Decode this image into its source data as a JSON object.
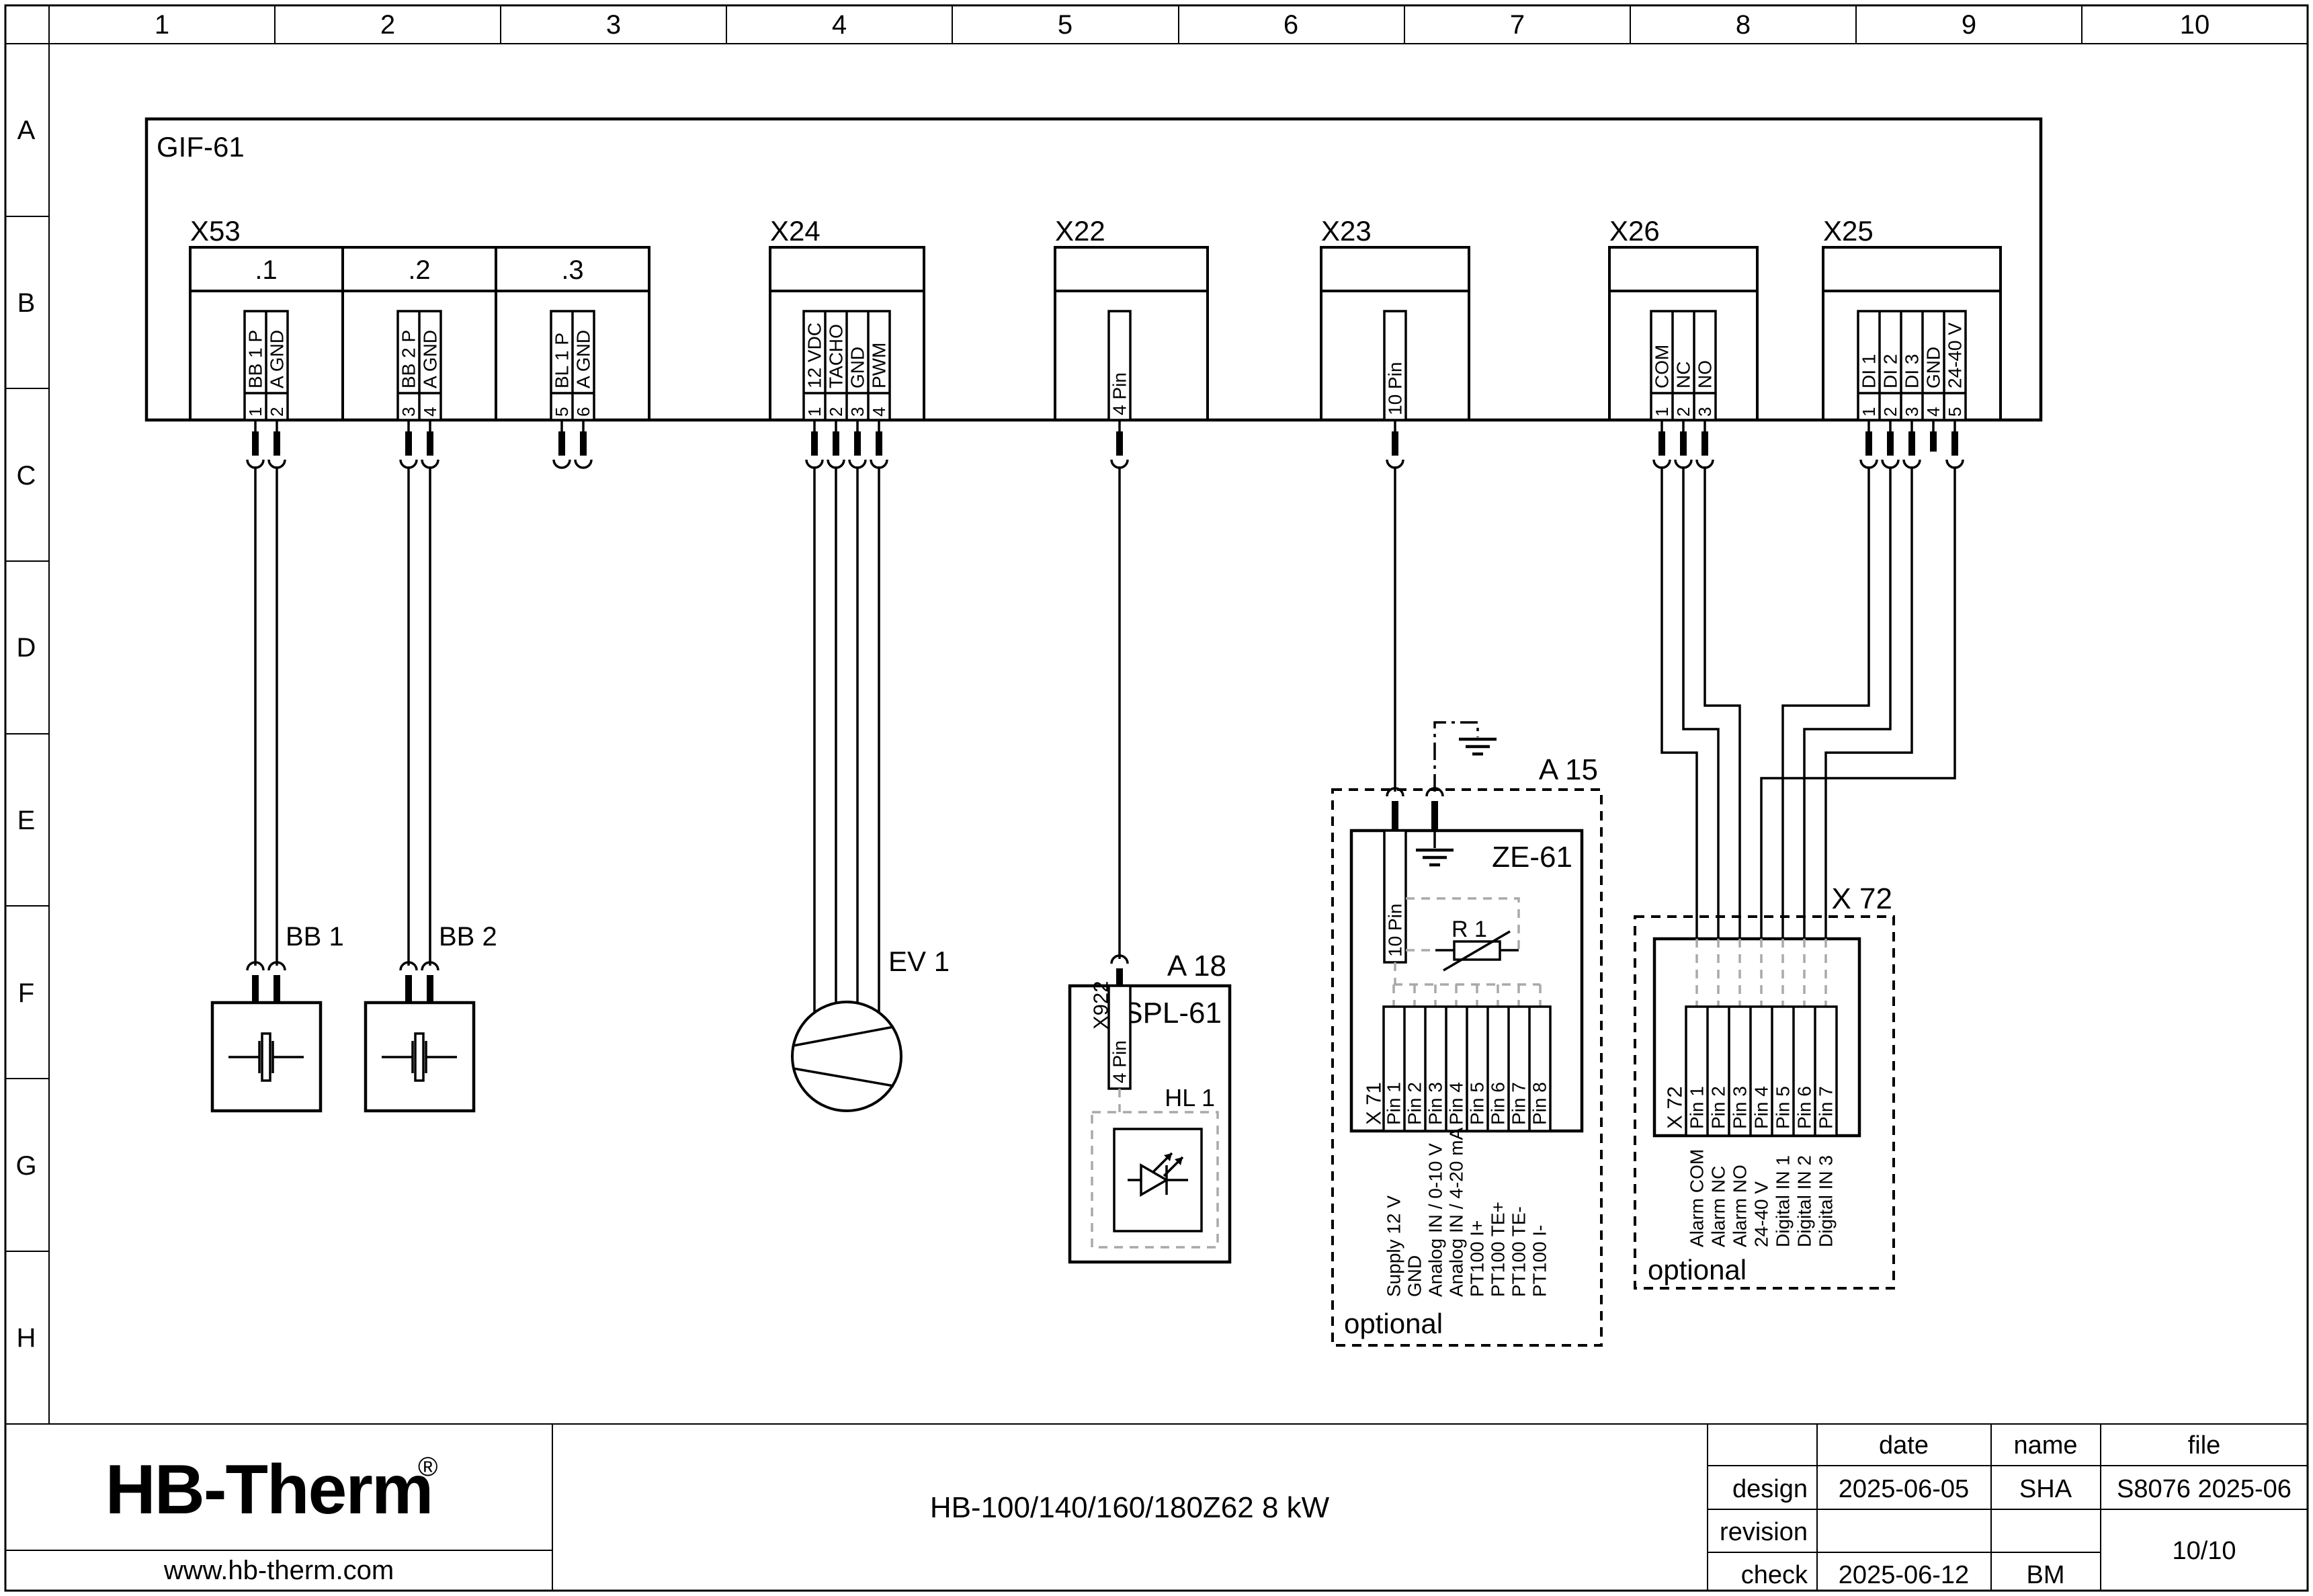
{
  "colors": {
    "line": "#000000",
    "gray_dash": "#a9a9a9",
    "logo_navy": "#1b2846"
  },
  "ruler": {
    "cols": [
      "1",
      "2",
      "3",
      "4",
      "5",
      "6",
      "7",
      "8",
      "9",
      "10"
    ],
    "rows": [
      "A",
      "B",
      "C",
      "D",
      "E",
      "F",
      "G",
      "H"
    ]
  },
  "unit": {
    "label": "GIF-61"
  },
  "x53": {
    "label": "X53",
    "cells": [
      ".1",
      ".2",
      ".3"
    ],
    "pins": [
      {
        "n": "1",
        "t": "BB 1 P"
      },
      {
        "n": "2",
        "t": "A GND"
      },
      {
        "n": "3",
        "t": "BB 2 P"
      },
      {
        "n": "4",
        "t": "A GND"
      },
      {
        "n": "5",
        "t": "BL 1 P"
      },
      {
        "n": "6",
        "t": "A GND"
      }
    ]
  },
  "x24": {
    "label": "X24",
    "pins": [
      {
        "n": "1",
        "t": "12 VDC"
      },
      {
        "n": "2",
        "t": "TACHO"
      },
      {
        "n": "3",
        "t": "GND"
      },
      {
        "n": "4",
        "t": "PWM"
      }
    ]
  },
  "x22": {
    "label": "X22",
    "pin": "4 Pin"
  },
  "x23": {
    "label": "X23",
    "pin": "10 Pin"
  },
  "x26": {
    "label": "X26",
    "pins": [
      {
        "n": "1",
        "t": "COM"
      },
      {
        "n": "2",
        "t": "NC"
      },
      {
        "n": "3",
        "t": "NO"
      }
    ]
  },
  "x25": {
    "label": "X25",
    "pins": [
      {
        "n": "1",
        "t": "DI 1"
      },
      {
        "n": "2",
        "t": "DI 2"
      },
      {
        "n": "3",
        "t": "DI 3"
      },
      {
        "n": "4",
        "t": "GND"
      },
      {
        "n": "5",
        "t": "24-40 V"
      }
    ]
  },
  "bb1": {
    "label": "BB 1"
  },
  "bb2": {
    "label": "BB 2"
  },
  "ev1": {
    "label": "EV 1"
  },
  "a18": {
    "label": "A 18",
    "module": "SPL-61",
    "connector": "X922",
    "connector_pin": "4 Pin",
    "lamp": "HL 1"
  },
  "a15": {
    "label": "A 15",
    "module": "ZE-61",
    "connector_pin": "10 Pin",
    "resistor": "R 1",
    "strip": "X 71",
    "pins": [
      "Pin 1",
      "Pin 2",
      "Pin 3",
      "Pin 4",
      "Pin 5",
      "Pin 6",
      "Pin 7",
      "Pin 8"
    ],
    "signals": [
      "Supply 12 V",
      "GND",
      "Analog IN / 0-10 V",
      "Analog IN / 4-20 mA",
      "PT100 I+",
      "PT100 TE+",
      "PT100 TE-",
      "PT100 I-"
    ],
    "optional": "optional"
  },
  "x72": {
    "label": "X 72",
    "strip": "X 72",
    "pins": [
      "Pin 1",
      "Pin 2",
      "Pin 3",
      "Pin 4",
      "Pin 5",
      "Pin 6",
      "Pin 7"
    ],
    "signals": [
      "Alarm COM",
      "Alarm NC",
      "Alarm NO",
      "24-40 V",
      "Digital IN 1",
      "Digital IN 2",
      "Digital IN 3"
    ],
    "optional": "optional"
  },
  "titleblock": {
    "logo": "HB-Therm",
    "logo_reg": "®",
    "website": "www.hb-therm.com",
    "title": "HB-100/140/160/180Z62 8 kW",
    "col_date": "date",
    "col_name": "name",
    "col_file": "file",
    "row_design": "design",
    "row_revision": "revision",
    "row_check": "check",
    "design_date": "2025-06-05",
    "design_name": "SHA",
    "file_id": "S8076 2025-06",
    "check_date": "2025-06-12",
    "check_name": "BM",
    "page": "10/10"
  }
}
